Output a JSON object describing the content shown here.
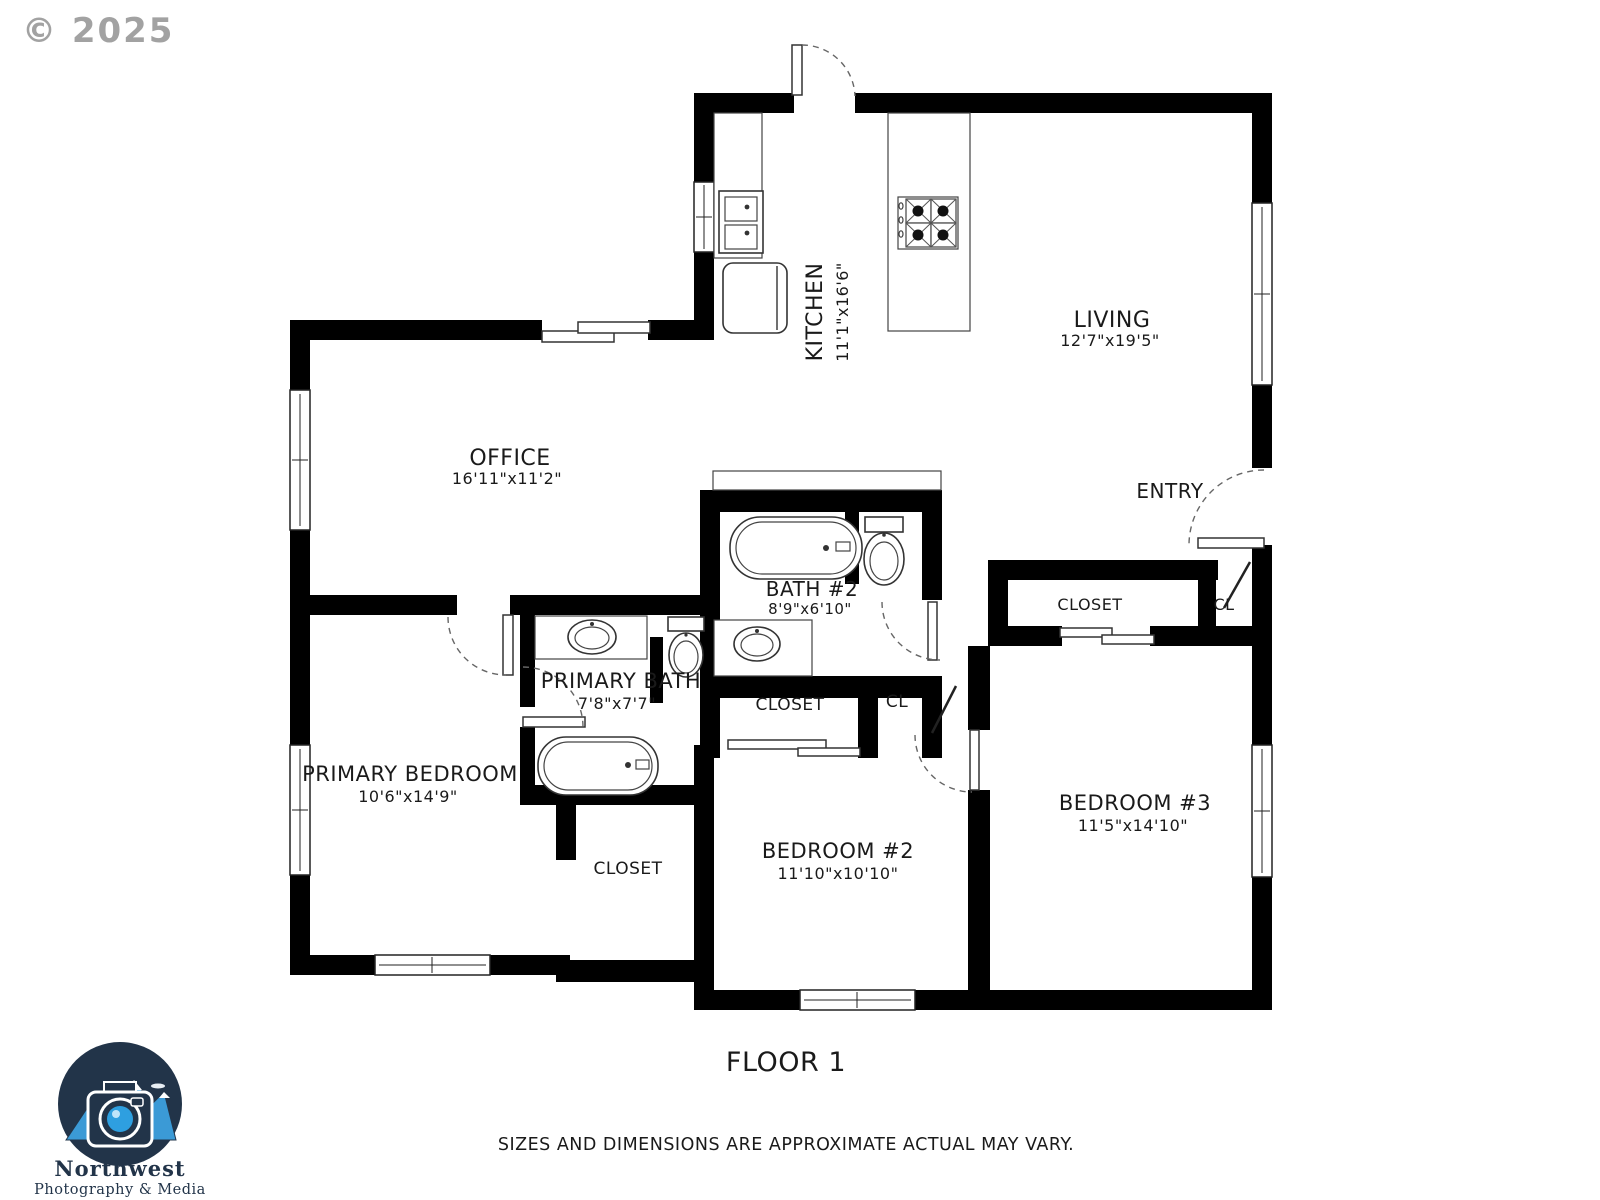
{
  "copyright": "© 2025",
  "floor_label": "FLOOR 1",
  "disclaimer": "SIZES AND DIMENSIONS ARE APPROXIMATE ACTUAL MAY VARY.",
  "logo": {
    "line1": "Northwest",
    "line2": "Photography & Media"
  },
  "rooms": {
    "kitchen": {
      "name": "KITCHEN",
      "dims": "11'1\"x16'6\""
    },
    "living": {
      "name": "LIVING",
      "dims": "12'7\"x19'5\""
    },
    "office": {
      "name": "OFFICE",
      "dims": "16'11\"x11'2\""
    },
    "entry": {
      "name": "ENTRY"
    },
    "bath2": {
      "name": "BATH #2",
      "dims": "8'9\"x6'10\""
    },
    "primary_bath": {
      "name": "PRIMARY BATH",
      "dims": "7'8\"x7'7\""
    },
    "primary_bedroom": {
      "name": "PRIMARY BEDROOM",
      "dims": "10'6\"x14'9\""
    },
    "bedroom2": {
      "name": "BEDROOM #2",
      "dims": "11'10\"x10'10\""
    },
    "bedroom3": {
      "name": "BEDROOM #3",
      "dims": "11'5\"x14'10\""
    },
    "closet_primary": {
      "name": "CLOSET"
    },
    "closet_bedroom2": {
      "name": "CLOSET"
    },
    "cl_hall": {
      "name": "CL"
    },
    "closet_bedroom3": {
      "name": "CLOSET"
    },
    "cl_entry": {
      "name": "CL"
    }
  },
  "colors": {
    "wall": "#000000",
    "label": "#1a1a1a",
    "copyright_gray": "#8c8c8c",
    "logo_navy": "#223449",
    "logo_blue": "#2e9fe0"
  }
}
